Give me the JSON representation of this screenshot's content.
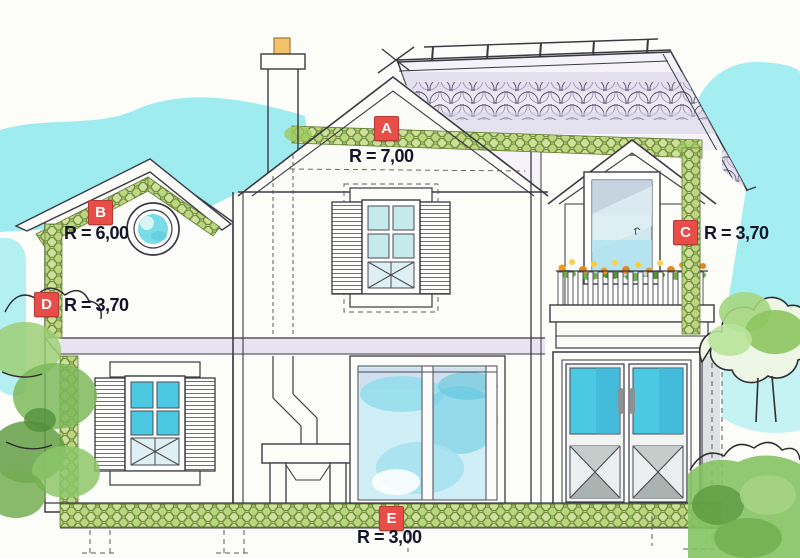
{
  "diagram_type": "house-insulation-section",
  "labels": [
    {
      "id": "A",
      "value": "R = 7,00"
    },
    {
      "id": "B",
      "value": "R = 6,00"
    },
    {
      "id": "C",
      "value": "R = 3,70"
    },
    {
      "id": "D",
      "value": "R = 3,70"
    },
    {
      "id": "E",
      "value": "R = 3,00"
    }
  ],
  "colors": {
    "badge": "#e84d48",
    "insulation": "#cfe09a",
    "insulation_line": "#6e8f3e",
    "sky": "#8de9ee",
    "glass": "#4cc9e2",
    "tiles": "#d6d1e8",
    "text": "#14142a",
    "line": "#3a3a42",
    "foliage": "#8cc76a"
  }
}
